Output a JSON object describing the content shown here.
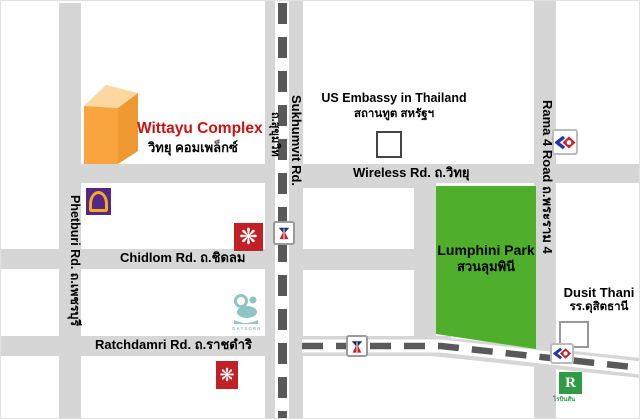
{
  "landmarks": {
    "wittayu": {
      "en": "Wittayu Complex",
      "th": "วิทยุ คอมเพล็กซ์"
    },
    "us_embassy": {
      "en": "US Embassy in Thailand",
      "th": "สถานทูต สหรัฐฯ"
    },
    "lumphini": {
      "en": "Lumphini Park",
      "th": "สวนลุมพินี"
    },
    "dusit_thani": {
      "en": "Dusit Thani",
      "th": "รร.ดุสิตธานี"
    },
    "gaysorn_label": "GAYSORN",
    "robinson_label": "โรบินสัน"
  },
  "roads": {
    "sukhumvit": {
      "en": "Sukhumvit Rd.",
      "th": "ถ.สุขุมวิท"
    },
    "wireless": {
      "en": "Wireless Rd.",
      "th": "ถ.วิทยุ"
    },
    "rama4": {
      "en": "Rama 4 Road",
      "th": "ถ.พระราม 4"
    },
    "phetburi": {
      "en": "Phetburi Rd.",
      "th": "ถ.เพชรบุรี"
    },
    "chidlom": {
      "en": "Chidlom Rd.",
      "th": "ถ.ชิดลม"
    },
    "ratchdamri": {
      "en": "Ratchdamri Rd.",
      "th": "ถ.ราชดำริ"
    }
  },
  "icons": {
    "central_glyph": "❋",
    "robinson_glyph": "R",
    "names": [
      "scb-bank-logo",
      "central-store-logo",
      "bts-station-logo",
      "mrt-station-logo",
      "gaysorn-logo",
      "robinson-logo"
    ]
  },
  "colors": {
    "road_gray": "#d6d6d6",
    "dash_dark": "#595959",
    "park_green": "#4faf2d",
    "building_orange": "#f8a43f",
    "building_top": "#fcd7a0",
    "title_red": "#cc1111",
    "scb_purple": "#52268a",
    "central_red": "#c02026",
    "gaysorn_teal": "#8fc3c4",
    "mrt_blue": "#2239a8",
    "mrt_red": "#c4202c",
    "robinson_green": "#2f9c45"
  }
}
